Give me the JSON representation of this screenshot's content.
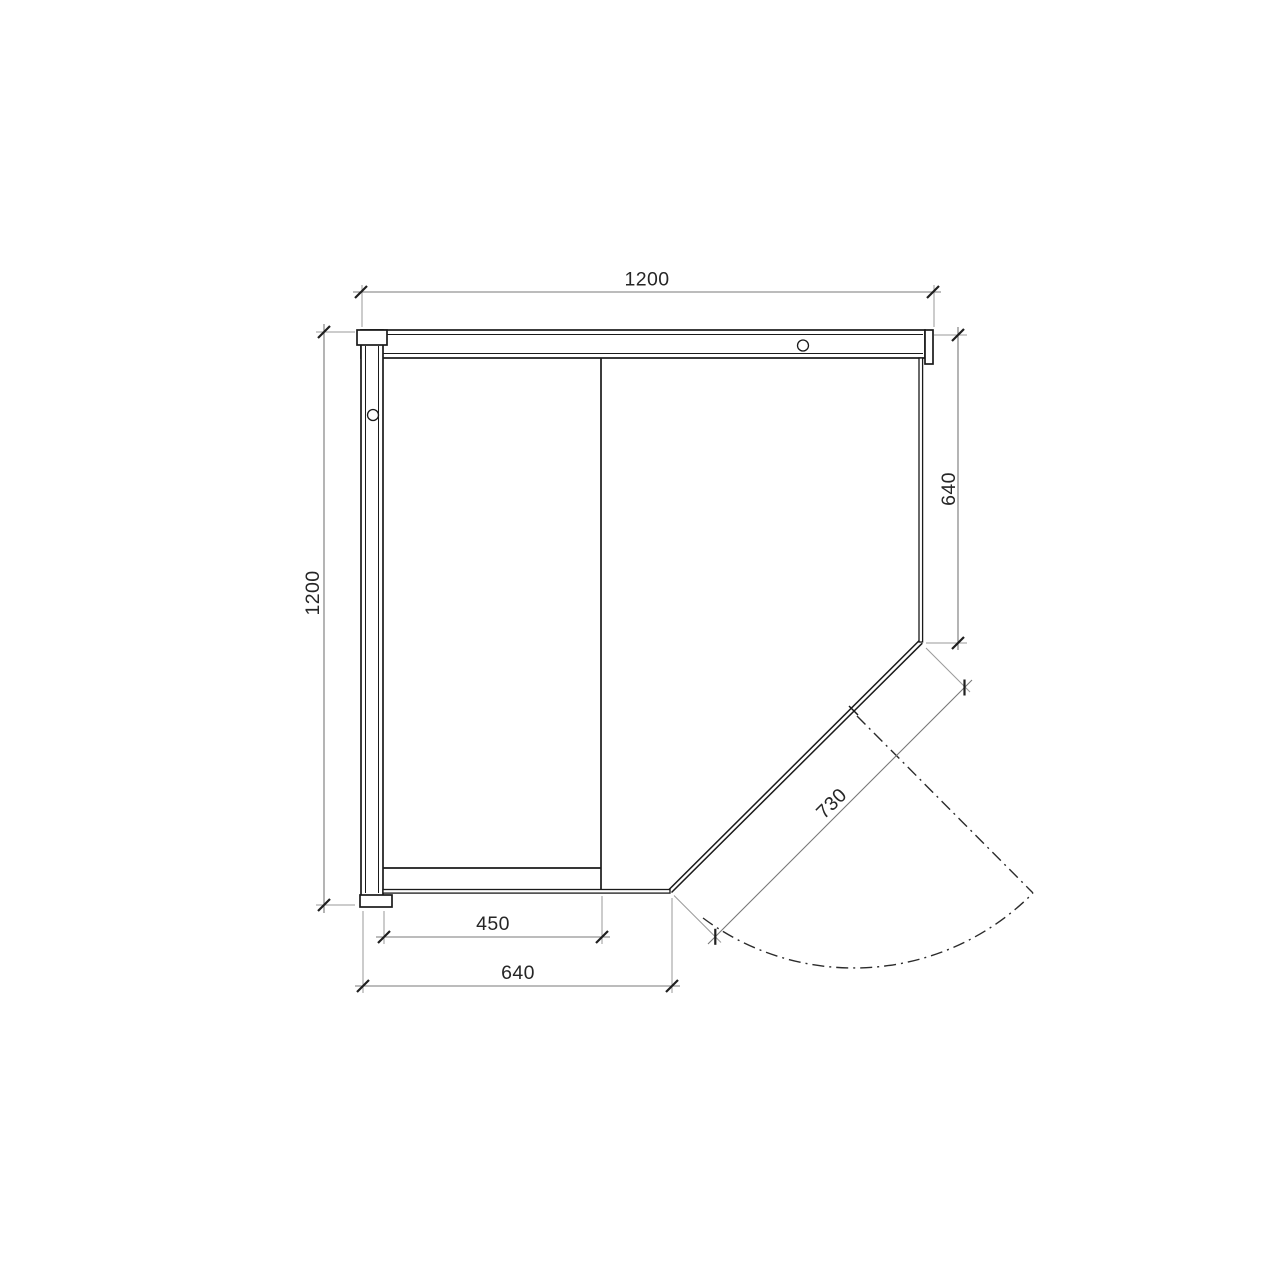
{
  "drawing": {
    "kind": "corner cabin floor plan",
    "units": "mm",
    "colors": {
      "background": "#ffffff",
      "object_line": "#1a1a1a",
      "dimension_line": "#787878",
      "extension_line": "#9a9a9a",
      "dimension_text": "#262626"
    },
    "dimensions": {
      "overall_width": "1200",
      "overall_depth": "1200",
      "right_panel_width": "640",
      "bottom_panel_width": "640",
      "inner_bay_width": "450",
      "door_diagonal_width": "730"
    },
    "features": [
      "thick top wall panel with round hole",
      "thick left wall panel with round hole",
      "thin right side panel",
      "thin bottom side panel",
      "diagonal corner door with hinge joint",
      "door open position and swing arc shown dash-dot",
      "interior divider line and bench line"
    ]
  }
}
